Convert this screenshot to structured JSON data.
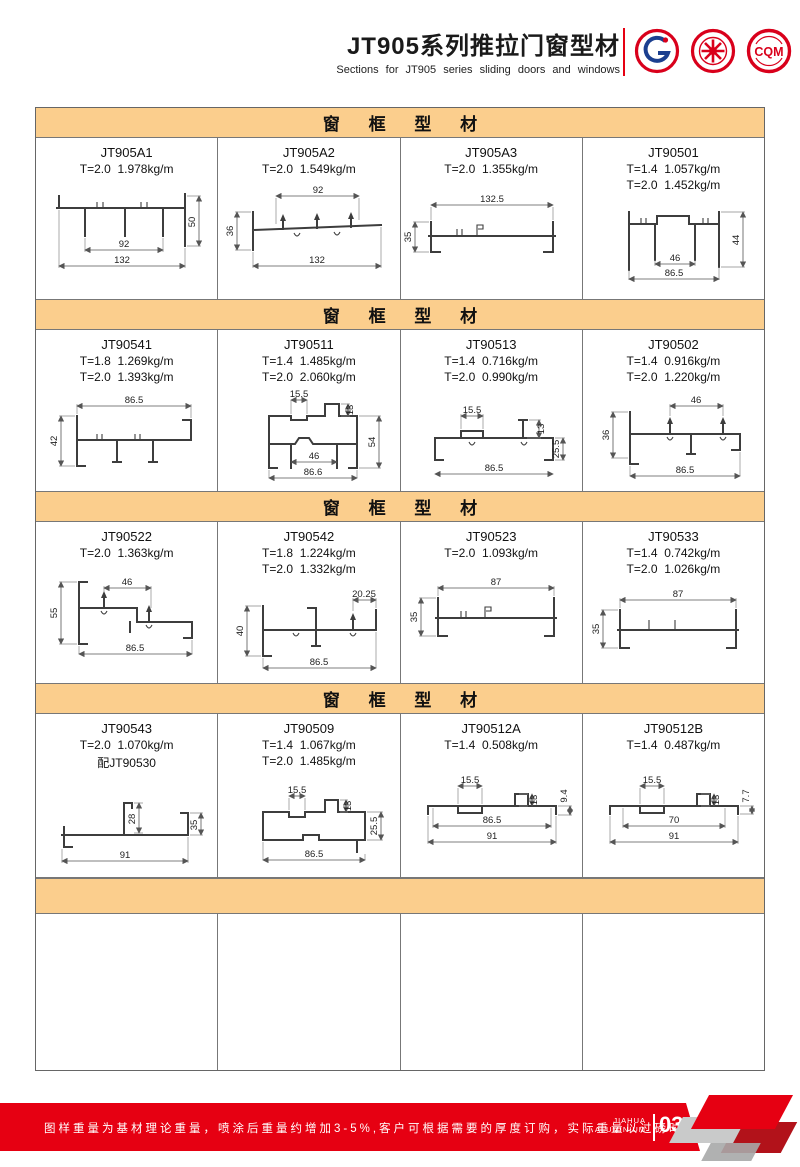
{
  "header": {
    "title": "JT905系列推拉门窗型材",
    "subtitle": "Sections for JT905 series sliding doors and windows",
    "logo_cqm": "CQM"
  },
  "sections": [
    {
      "banner": "窗 框 型 材",
      "cells": [
        {
          "code": "JT905A1",
          "specs": [
            "T=2.0  1.978kg/m"
          ],
          "dims": [
            "50",
            "92",
            "132"
          ]
        },
        {
          "code": "JT905A2",
          "specs": [
            "T=2.0  1.549kg/m"
          ],
          "dims": [
            "92",
            "36",
            "132"
          ]
        },
        {
          "code": "JT905A3",
          "specs": [
            "T=2.0  1.355kg/m"
          ],
          "dims": [
            "132.5",
            "35"
          ]
        },
        {
          "code": "JT90501",
          "specs": [
            "T=1.4  1.057kg/m",
            "T=2.0  1.452kg/m"
          ],
          "dims": [
            "44",
            "46",
            "86.5"
          ]
        }
      ]
    },
    {
      "banner": "窗 框 型 材",
      "cells": [
        {
          "code": "JT90541",
          "specs": [
            "T=1.8  1.269kg/m",
            "T=2.0  1.393kg/m"
          ],
          "dims": [
            "86.5",
            "42"
          ]
        },
        {
          "code": "JT90511",
          "specs": [
            "T=1.4  1.485kg/m",
            "T=2.0  2.060kg/m"
          ],
          "dims": [
            "15.5",
            "13",
            "54",
            "46",
            "86.6"
          ]
        },
        {
          "code": "JT90513",
          "specs": [
            "T=1.4  0.716kg/m",
            "T=2.0  0.990kg/m"
          ],
          "dims": [
            "15.5",
            "13",
            "25.5",
            "86.5"
          ]
        },
        {
          "code": "JT90502",
          "specs": [
            "T=1.4  0.916kg/m",
            "T=2.0  1.220kg/m"
          ],
          "dims": [
            "46",
            "36",
            "86.5"
          ]
        }
      ]
    },
    {
      "banner": "窗 框 型 材",
      "cells": [
        {
          "code": "JT90522",
          "specs": [
            "T=2.0  1.363kg/m"
          ],
          "dims": [
            "46",
            "55",
            "86.5"
          ]
        },
        {
          "code": "JT90542",
          "specs": [
            "T=1.8  1.224kg/m",
            "T=2.0  1.332kg/m"
          ],
          "dims": [
            "20.25",
            "40",
            "86.5"
          ]
        },
        {
          "code": "JT90523",
          "specs": [
            "T=2.0  1.093kg/m"
          ],
          "dims": [
            "87",
            "35"
          ]
        },
        {
          "code": "JT90533",
          "specs": [
            "T=1.4  0.742kg/m",
            "T=2.0  1.026kg/m"
          ],
          "dims": [
            "87",
            "35"
          ]
        }
      ]
    },
    {
      "banner": "窗 框 型 材",
      "cells": [
        {
          "code": "JT90543",
          "specs": [
            "T=2.0  1.070kg/m",
            "配JT90530"
          ],
          "dims": [
            "28",
            "35",
            "91"
          ]
        },
        {
          "code": "JT90509",
          "specs": [
            "T=1.4  1.067kg/m",
            "T=2.0  1.485kg/m"
          ],
          "dims": [
            "15.5",
            "13",
            "25.5",
            "86.5"
          ]
        },
        {
          "code": "JT90512A",
          "specs": [
            "T=1.4  0.508kg/m"
          ],
          "dims": [
            "15.5",
            "13",
            "9.4",
            "86.5",
            "91"
          ]
        },
        {
          "code": "JT90512B",
          "specs": [
            "T=1.4  0.487kg/m"
          ],
          "dims": [
            "15.5",
            "13",
            "7.7",
            "70",
            "91"
          ]
        }
      ]
    }
  ],
  "footer": {
    "note": "图样重量为基材理论重量，喷涂后重量约增加3-5%,客户可根据需要的厚度订购，实际重量以过磅时的重量为准。",
    "brand_top": "JIAHUA",
    "brand_bottom": "ALUMINIUM",
    "page_number": "03"
  },
  "colors": {
    "banner_bg": "#FBCE8D",
    "accent_red": "#E60012"
  }
}
